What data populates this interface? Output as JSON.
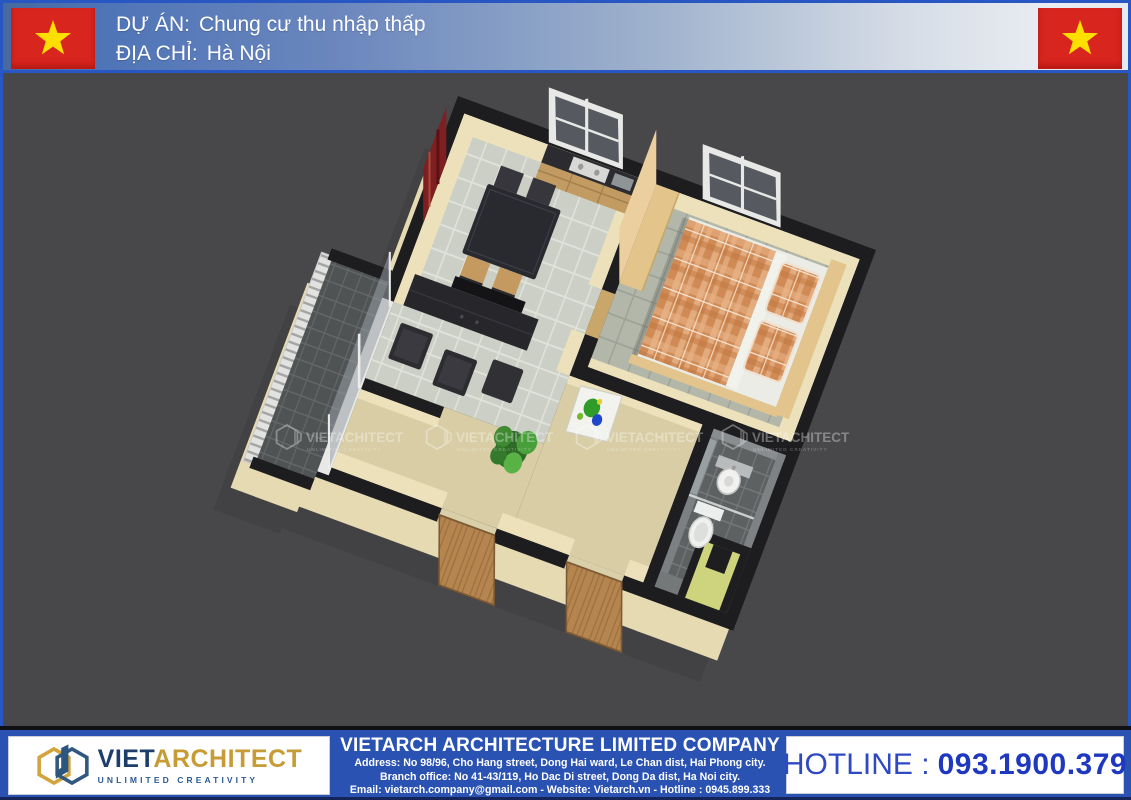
{
  "header": {
    "flag": "vietnam-flag",
    "project_label": "DỰ ÁN:",
    "project_value": "Chung cư thu nhập thấp",
    "address_label": "ĐỊA CHỈ:",
    "address_value": "Hà Nội"
  },
  "watermark": {
    "brand": "VIETACHITECT",
    "tagline": "UNLIMITED CREATIVITY"
  },
  "footer": {
    "logo": {
      "brand_part1": "VIET",
      "brand_part2": "ARCHITECT",
      "tagline": "UNLIMITED CREATIVITY"
    },
    "company_name": "VIETARCH ARCHITECTURE LIMITED COMPANY",
    "address_line1": "Address: No 98/96, Cho Hang street, Dong Hai ward, Le Chan dist, Hai Phong city.",
    "address_line2": "Branch office: No 41-43/119, Ho Dac Di street, Dong Da dist, Ha Noi city.",
    "address_line3": "Email: vietarch.company@gmail.com - Website: Vietarch.vn - Hotline : 0945.899.333",
    "hotline_label": "HOTLINE :",
    "hotline_number": "093.1900.379"
  },
  "colors": {
    "header_border": "#2856c2",
    "flag_red": "#d8251e",
    "star_yellow": "#ffdf00",
    "canvas_gray": "#48484a",
    "footer_blue": "#2a52b2",
    "brand_navy": "#1d3e6b",
    "brand_gold": "#c79b35"
  }
}
